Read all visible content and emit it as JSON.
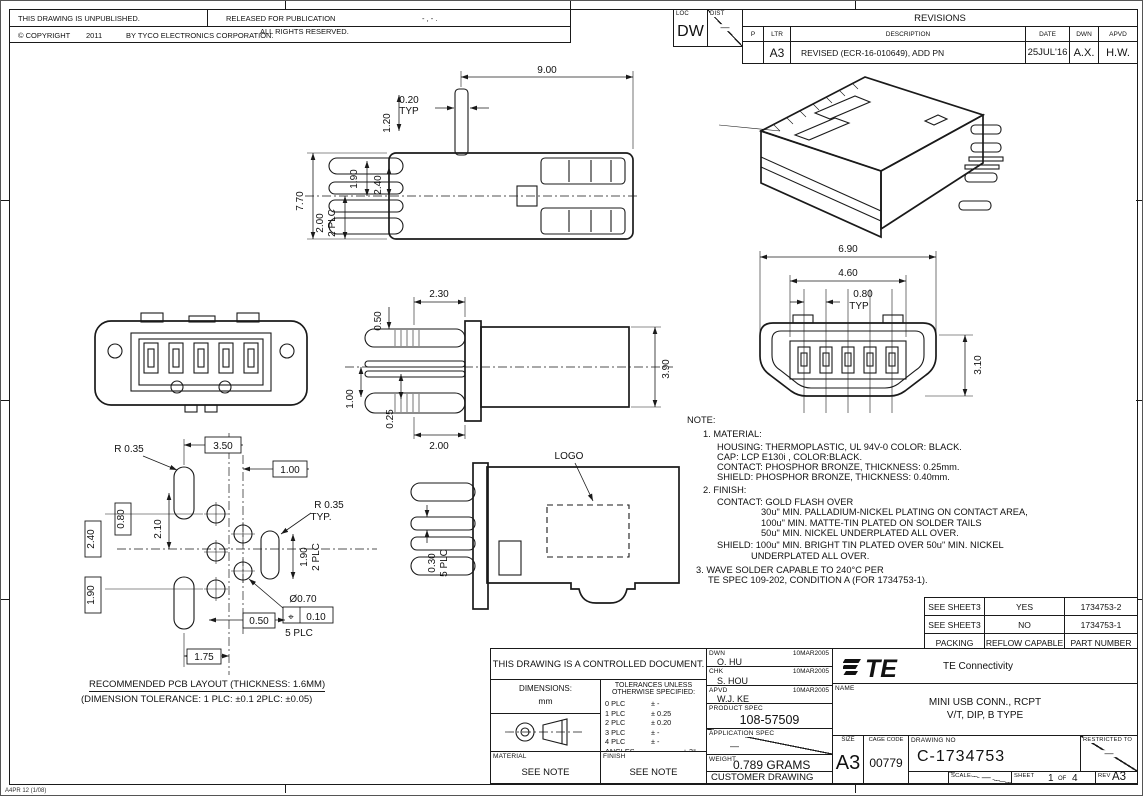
{
  "page": {
    "footer_code": "A4PR 12 (1/08)"
  },
  "header": {
    "unpublished": "THIS DRAWING IS UNPUBLISHED.",
    "released": "RELEASED FOR PUBLICATION",
    "released_value": "-  ,  -     .",
    "copyright": "© COPYRIGHT",
    "year": "2011",
    "by_text": "BY TYCO ELECTRONICS CORPORATION.",
    "rights": "ALL RIGHTS RESERVED."
  },
  "revisions": {
    "loc_label": "LOC",
    "loc_value": "DW",
    "dist_label": "DIST",
    "title": "REVISIONS",
    "col_p": "P",
    "col_ltr": "LTR",
    "col_description": "DESCRIPTION",
    "col_date": "DATE",
    "col_dwn": "DWN",
    "col_apvd": "APVD",
    "row": {
      "ltr": "A3",
      "description": "REVISED (ECR-16-010649), ADD PN",
      "date": "25JUL'16",
      "dwn": "A.X.",
      "apvd": "H.W."
    }
  },
  "views": {
    "top": {
      "d_900": "9.00",
      "d_020": "0.20",
      "typ": "TYP",
      "d_120": "1.20",
      "d_190": "1.90",
      "d_240": "2.40",
      "d_770": "7.70",
      "d_200": "2.00",
      "plc2": "2 PLC"
    },
    "side": {
      "d_230": "2.30",
      "d_050": "0.50",
      "d_100": "1.00",
      "d_025": "0.25",
      "d_200": "2.00",
      "d_390": "3.90"
    },
    "front": {
      "d_690": "6.90",
      "d_460": "4.60",
      "d_080": "0.80",
      "typ": "TYP",
      "d_310": "3.10"
    },
    "pcb": {
      "r035_left": "R 0.35",
      "d_350": "3.50",
      "d_100": "1.00",
      "r035_right": "R 0.35",
      "typ": "TYP.",
      "d_210": "2.10",
      "d_080": "0.80",
      "d_240": "2.40",
      "d_190_left": "1.90",
      "d_190_right": "1.90",
      "plc2": "2 PLC",
      "dia": "Ø0.70",
      "pos_sym": "⌖",
      "pos_tol": "0.10",
      "plc5": "5 PLC",
      "d_050": "0.50",
      "d_175": "1.75"
    },
    "logo": {
      "label": "LOGO",
      "d_030": "0.30",
      "plc5": "5 PLC"
    }
  },
  "notes": {
    "lines": [
      "NOTE:",
      "1. MATERIAL:",
      "HOUSING: THERMOPLASTIC, UL 94V-0 COLOR: BLACK.",
      "CAP: LCP E130i , COLOR:BLACK.",
      "CONTACT: PHOSPHOR BRONZE, THICKNESS: 0.25mm.",
      "SHIELD: PHOSPHOR BRONZE, THICKNESS: 0.40mm.",
      "2. FINISH:",
      "CONTACT: GOLD FLASH OVER",
      "30u\" MIN. PALLADIUM-NICKEL PLATING ON CONTACT AREA,",
      "100u\" MIN. MATTE-TIN PLATED ON SOLDER TAILS",
      "50u\" MIN. NICKEL UNDERPLATED ALL OVER.",
      "SHIELD: 100u\" MIN. BRIGHT TIN PLATED OVER 50u\" MIN. NICKEL",
      "UNDERPLATED ALL OVER.",
      "3. WAVE SOLDER CAPABLE TO 240°C PER",
      "TE SPEC 109-202, CONDITION A (FOR 1734753-1)."
    ]
  },
  "pcb_caption": {
    "line1": "RECOMMENDED PCB LAYOUT (THICKNESS: 1.6MM)",
    "line2": "(DIMENSION TOLERANCE: 1 PLC: ±0.1    2PLC: ±0.05)"
  },
  "sheet_table": {
    "rows": [
      {
        "c1": "SEE SHEET3",
        "c2": "YES",
        "c3": "1734753-2"
      },
      {
        "c1": "SEE SHEET3",
        "c2": "NO",
        "c3": "1734753-1"
      },
      {
        "c1": "PACKING",
        "c2": "REFLOW CAPABLE",
        "c3": "PART NUMBER"
      }
    ]
  },
  "title_block": {
    "controlled": "THIS DRAWING IS A CONTROLLED DOCUMENT.",
    "dimensions_label": "DIMENSIONS:",
    "dimensions_unit": "mm",
    "tol_title1": "TOLERANCES UNLESS",
    "tol_title2": "OTHERWISE SPECIFIED:",
    "tol_rows": [
      {
        "k": "0 PLC",
        "v": "± -"
      },
      {
        "k": "1 PLC",
        "v": "± 0.25"
      },
      {
        "k": "2 PLC",
        "v": "± 0.20"
      },
      {
        "k": "3 PLC",
        "v": "± -"
      },
      {
        "k": "4 PLC",
        "v": "± -"
      },
      {
        "k": "ANGLES",
        "v": "± 3°"
      }
    ],
    "material_label": "MATERIAL",
    "material_value": "SEE NOTE",
    "finish_label": "FINISH",
    "finish_value": "SEE NOTE",
    "dwn_label": "DWN",
    "dwn_name": "O. HU",
    "dwn_date": "10MAR2005",
    "chk_label": "CHK",
    "chk_name": "S. HOU",
    "chk_date": "10MAR2005",
    "apvd_label": "APVD",
    "apvd_name": "W.J. KE",
    "apvd_date": "10MAR2005",
    "product_spec_label": "PRODUCT SPEC",
    "product_spec_value": "108-57509",
    "application_spec_label": "APPLICATION SPEC",
    "weight_label": "WEIGHT",
    "weight_value": "0.789  GRAMS",
    "customer_drawing": "CUSTOMER  DRAWING",
    "brand_te": "TE",
    "brand_name": "TE  Connectivity",
    "name_label": "NAME",
    "name_line1": "MINI USB CONN., RCPT",
    "name_line2": "V/T, DIP, B TYPE",
    "size_label": "SIZE",
    "size_value": "A3",
    "cage_label": "CAGE CODE",
    "cage_value": "00779",
    "drawing_no_label": "DRAWING NO",
    "drawing_no_value": "C-1734753",
    "restricted_label": "RESTRICTED TO",
    "scale_label": "SCALE",
    "scale_value": "—",
    "sheet_label": "SHEET",
    "sheet_value": "1",
    "sheet_of": "OF",
    "sheet_total": "4",
    "rev_label": "REV",
    "rev_value": "A3"
  }
}
